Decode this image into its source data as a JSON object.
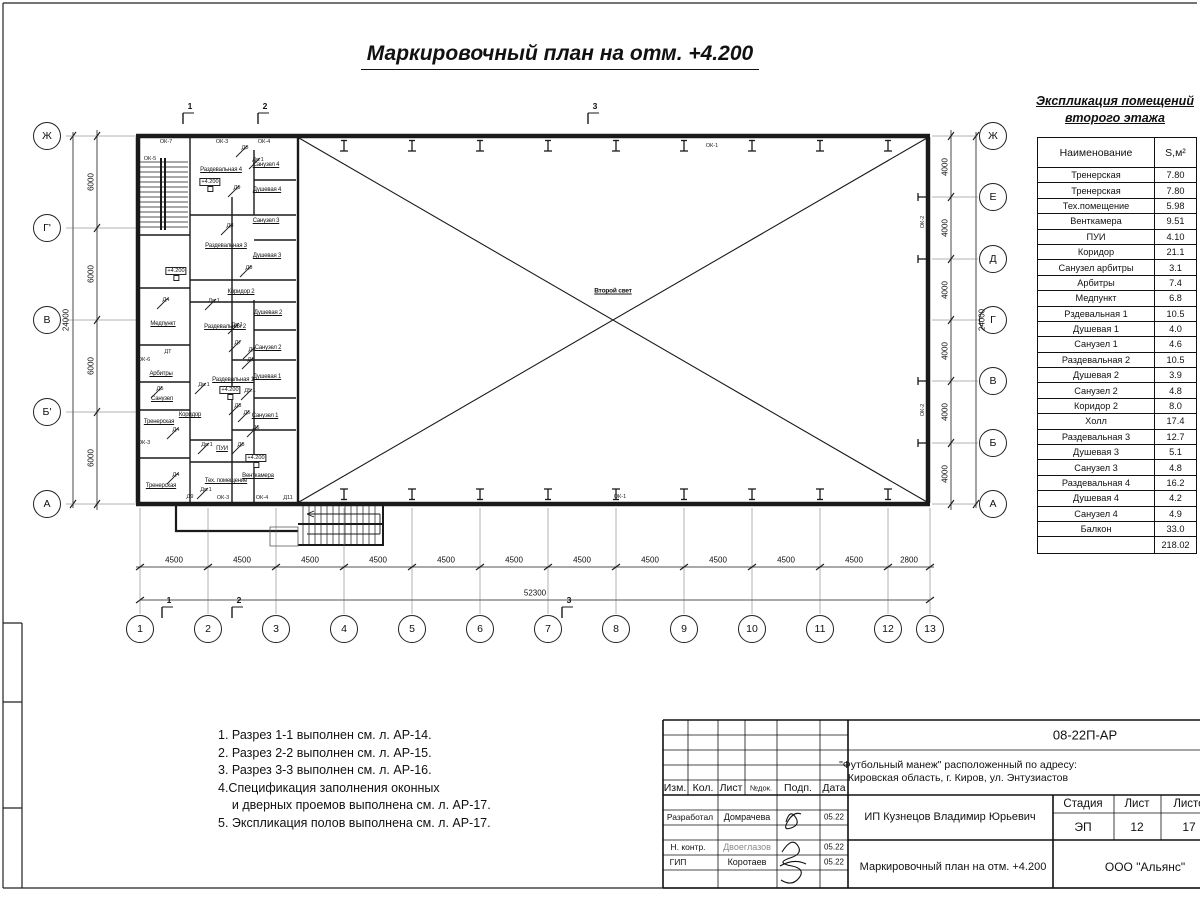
{
  "sheet": {
    "title": "Маркировочный план на отм. +4.200"
  },
  "explication": {
    "title_line1": "Экспликация помещений",
    "title_line2": "второго этажа",
    "columns": {
      "name": "Наименование",
      "area": "S,м²"
    },
    "rows": [
      [
        "Тренерская",
        "7.80"
      ],
      [
        "Тренерская",
        "7.80"
      ],
      [
        "Тех.помещение",
        "5.98"
      ],
      [
        "Венткамера",
        "9.51"
      ],
      [
        "ПУИ",
        "4.10"
      ],
      [
        "Коридор",
        "21.1"
      ],
      [
        "Санузел арбитры",
        "3.1"
      ],
      [
        "Арбитры",
        "7.4"
      ],
      [
        "Медпункт",
        "6.8"
      ],
      [
        "Рздевальная 1",
        "10.5"
      ],
      [
        "Душевая 1",
        "4.0"
      ],
      [
        "Санузел 1",
        "4.6"
      ],
      [
        "Раздевальная 2",
        "10.5"
      ],
      [
        "Душевая 2",
        "3.9"
      ],
      [
        "Санузел 2",
        "4.8"
      ],
      [
        "Коридор 2",
        "8.0"
      ],
      [
        "Холл",
        "17.4"
      ],
      [
        "Раздевальная 3",
        "12.7"
      ],
      [
        "Душевая 3",
        "5.1"
      ],
      [
        "Санузел 3",
        "4.8"
      ],
      [
        "Раздевальная 4",
        "16.2"
      ],
      [
        "Душевая 4",
        "4.2"
      ],
      [
        "Санузел 4",
        "4.9"
      ],
      [
        "Балкон",
        "33.0"
      ]
    ],
    "total": "218.02"
  },
  "notes": [
    "1. Разрез 1-1 выполнен см. л. АР-14.",
    "2. Разрез 2-2 выполнен см. л. АР-15.",
    "3. Разрез 3-3 выполнен см. л. АР-16.",
    "4.Спецификация заполнения оконных",
    "    и дверных проемов выполнена см. л. АР-17.",
    "5. Экспликация полов выполнена см. л. АР-17."
  ],
  "axes": {
    "bottom_labels": [
      "1",
      "2",
      "3",
      "4",
      "5",
      "6",
      "7",
      "8",
      "9",
      "10",
      "11",
      "12",
      "13"
    ],
    "bottom_dims": [
      "4500",
      "4500",
      "4500",
      "4500",
      "4500",
      "4500",
      "4500",
      "4500",
      "4500",
      "4500",
      "4500",
      "2800"
    ],
    "bottom_total": "52300",
    "left_labels": [
      "Ж",
      "Г'",
      "В",
      "Б'",
      "А"
    ],
    "left_dims": [
      "6000",
      "6000",
      "6000",
      "6000"
    ],
    "left_total": "24000",
    "right_labels": [
      "Ж",
      "Е",
      "Д",
      "Г",
      "В",
      "Б",
      "А"
    ],
    "right_dims": [
      "4000",
      "4000",
      "4000",
      "4000",
      "4000",
      "4000"
    ],
    "right_total": "24000"
  },
  "section_markers": {
    "top": [
      {
        "n": "1",
        "x": 183
      },
      {
        "n": "2",
        "x": 258
      },
      {
        "n": "3",
        "x": 588
      }
    ],
    "bottom": [
      {
        "n": "1",
        "x": 162
      },
      {
        "n": "2",
        "x": 232
      },
      {
        "n": "3",
        "x": 562
      }
    ]
  },
  "plan": {
    "rooms": [
      {
        "t": "Раздевальная 4",
        "x": 221,
        "y": 170
      },
      {
        "t": "Санузел 4",
        "x": 266,
        "y": 165
      },
      {
        "t": "Душевая 4",
        "x": 267,
        "y": 190
      },
      {
        "t": "Санузел 3",
        "x": 266,
        "y": 221
      },
      {
        "t": "Раздевальная 3",
        "x": 226,
        "y": 246
      },
      {
        "t": "Душевая 3",
        "x": 267,
        "y": 256
      },
      {
        "t": "Коридор 2",
        "x": 241,
        "y": 292
      },
      {
        "t": "Медпункт",
        "x": 163,
        "y": 324
      },
      {
        "t": "Душевая 2",
        "x": 268,
        "y": 313
      },
      {
        "t": "Раздевальная 2",
        "x": 225,
        "y": 327
      },
      {
        "t": "Санузел 2",
        "x": 268,
        "y": 348
      },
      {
        "t": "Арбитры",
        "x": 161,
        "y": 374
      },
      {
        "t": "Душевая 1",
        "x": 267,
        "y": 377
      },
      {
        "t": "Раздевальная 1",
        "x": 233,
        "y": 380
      },
      {
        "t": "Санузел",
        "x": 162,
        "y": 399
      },
      {
        "t": "Коридор",
        "x": 190,
        "y": 415
      },
      {
        "t": "Санузел 1",
        "x": 265,
        "y": 416
      },
      {
        "t": "Тренерская",
        "x": 159,
        "y": 422
      },
      {
        "t": "ПУИ",
        "x": 222,
        "y": 449
      },
      {
        "t": "Венткамера",
        "x": 258,
        "y": 476
      },
      {
        "t": "Тех. помещение",
        "x": 226,
        "y": 481
      },
      {
        "t": "Тренерская",
        "x": 161,
        "y": 486
      },
      {
        "t": "Второй свет",
        "x": 613,
        "y": 291,
        "big": 1
      }
    ],
    "small_labels": [
      {
        "t": "ОК-7",
        "x": 166,
        "y": 142
      },
      {
        "t": "ОК-3",
        "x": 222,
        "y": 142
      },
      {
        "t": "ОК-4",
        "x": 264,
        "y": 142
      },
      {
        "t": "ОК-5",
        "x": 150,
        "y": 159
      },
      {
        "t": "Д8",
        "x": 245,
        "y": 148,
        "d": 1
      },
      {
        "t": "Дв.1",
        "x": 258,
        "y": 160,
        "d": 1
      },
      {
        "t": "Д9",
        "x": 237,
        "y": 188,
        "d": 1
      },
      {
        "t": "Д8",
        "x": 230,
        "y": 226,
        "d": 1
      },
      {
        "t": "Д8",
        "x": 249,
        "y": 268,
        "d": 1
      },
      {
        "t": "Д4",
        "x": 166,
        "y": 300,
        "d": 1
      },
      {
        "t": "Дв.1",
        "x": 214,
        "y": 301,
        "d": 1
      },
      {
        "t": "Дв.1",
        "x": 237,
        "y": 325,
        "d": 1
      },
      {
        "t": "Д7",
        "x": 238,
        "y": 343,
        "d": 1
      },
      {
        "t": "Д8",
        "x": 252,
        "y": 350,
        "d": 1
      },
      {
        "t": "ДТ",
        "x": 168,
        "y": 352
      },
      {
        "t": "Д6",
        "x": 251,
        "y": 360,
        "d": 1
      },
      {
        "t": "ОК-6",
        "x": 144,
        "y": 360
      },
      {
        "t": "Дв.1",
        "x": 204,
        "y": 385,
        "d": 1
      },
      {
        "t": "Д5",
        "x": 160,
        "y": 389,
        "d": 1
      },
      {
        "t": "Д5.1",
        "x": 250,
        "y": 391,
        "d": 1
      },
      {
        "t": "Д3",
        "x": 238,
        "y": 406,
        "d": 1
      },
      {
        "t": "Д5",
        "x": 247,
        "y": 413,
        "d": 1
      },
      {
        "t": "Д6",
        "x": 256,
        "y": 428,
        "d": 1
      },
      {
        "t": "Д4",
        "x": 176,
        "y": 430,
        "d": 1
      },
      {
        "t": "ОК-3",
        "x": 144,
        "y": 443
      },
      {
        "t": "Дв.1",
        "x": 207,
        "y": 445,
        "d": 1
      },
      {
        "t": "Д8",
        "x": 241,
        "y": 445,
        "d": 1
      },
      {
        "t": "Д4",
        "x": 176,
        "y": 475,
        "d": 1
      },
      {
        "t": "Дв.1",
        "x": 206,
        "y": 490,
        "d": 1
      },
      {
        "t": "Д9",
        "x": 190,
        "y": 497
      },
      {
        "t": "ОК-3",
        "x": 223,
        "y": 498
      },
      {
        "t": "ОК-4",
        "x": 262,
        "y": 498
      },
      {
        "t": "Д11",
        "x": 288,
        "y": 498
      },
      {
        "t": "ОК-1",
        "x": 712,
        "y": 146
      },
      {
        "t": "ОК-1",
        "x": 620,
        "y": 497
      },
      {
        "t": "ОК-2",
        "x": 923,
        "y": 222,
        "rot": 1
      },
      {
        "t": "ОК-2",
        "x": 923,
        "y": 410,
        "rot": 1
      }
    ],
    "elevation_marks": [
      {
        "t": "+4.200",
        "x": 210,
        "y": 182
      },
      {
        "t": "+4.200",
        "x": 176,
        "y": 271
      },
      {
        "t": "+4.200",
        "x": 230,
        "y": 390
      },
      {
        "t": "+4.200",
        "x": 256,
        "y": 458
      }
    ]
  },
  "titleblock": {
    "doc_number": "08-22П-АР",
    "object_line1": "\"Футбольный манеж\" расположенный по адресу:",
    "object_line2": "Кировская область, г. Киров, ул. Энтузиастов",
    "header_cells": [
      "Изм.",
      "Кол.",
      "Лист",
      "№док.",
      "Подп.",
      "Дата"
    ],
    "rows": [
      {
        "role": "Разработал",
        "name": "Домрачева",
        "date": "05.22"
      },
      {
        "role": "Н. контр.",
        "name": "Двоеглазов",
        "date": "05.22"
      },
      {
        "role": "ГИП",
        "name": "Коротаев",
        "date": "05.22"
      }
    ],
    "client": "ИП Кузнецов Владимир Юрьевич",
    "stage_label": "Стадия",
    "sheet_label": "Лист",
    "sheets_label": "Листов",
    "stage": "ЭП",
    "sheet": "12",
    "sheets": "17",
    "drawing_title": "Маркировочный план на отм. +4.200",
    "company": "ООО \"Альянс\""
  }
}
